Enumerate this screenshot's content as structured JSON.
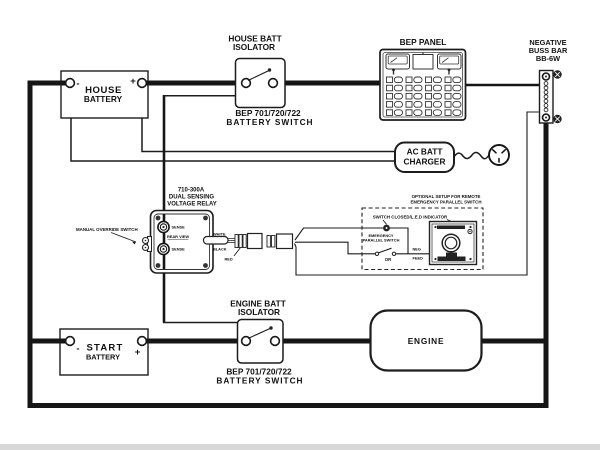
{
  "diagram": {
    "house_battery": {
      "name_1": "HOUSE",
      "name_2": "BATTERY",
      "minus": "-",
      "plus": "+"
    },
    "start_battery": {
      "minus": "-",
      "name_1": "START",
      "name_2": "BATTERY",
      "plus": "+"
    },
    "house_isolator": {
      "label_1": "HOUSE BATT",
      "label_2": "ISOLATOR",
      "model_1": "BEP 701/720/722",
      "model_2": "BATTERY SWITCH"
    },
    "engine_isolator": {
      "label_1": "ENGINE BATT",
      "label_2": "ISOLATOR",
      "model_1": "BEP 701/720/722",
      "model_2": "BATTERY SWITCH"
    },
    "bep_panel": {
      "label": "BEP PANEL"
    },
    "buss_bar": {
      "label_1": "NEGATIVE",
      "label_2": "BUSS BAR",
      "label_3": "BB-6W"
    },
    "charger": {
      "label_1": "AC BATT",
      "label_2": "CHARGER"
    },
    "relay": {
      "model": "710-300A",
      "type_1": "DUAL SENSING",
      "type_2": "VOLTAGE RELAY",
      "override_label": "MANUAL OVERRIDE SWITCH",
      "terminal_top": "SENSE",
      "terminal_bottom": "SENSE",
      "view": "REAR VIEW",
      "wire_1": "WHITE",
      "wire_2": "BLACK",
      "wire_3": "RED"
    },
    "optional": {
      "title_1": "OPTIONAL SETUP FOR REMOTE",
      "title_2": "EMERGENCY PARALLEL SWITCH",
      "indicator": "SWITCH CLOSED/L.E.D INDICATOR",
      "switch_1": "EMERGENCY",
      "switch_2": "PARALLEL SWITCH",
      "or": "OR",
      "feed_1": "NEG",
      "feed_2": "FEED"
    },
    "engine": {
      "label": "ENGINE"
    },
    "colors": {
      "line": "#161616",
      "background": "#ffffff"
    }
  }
}
